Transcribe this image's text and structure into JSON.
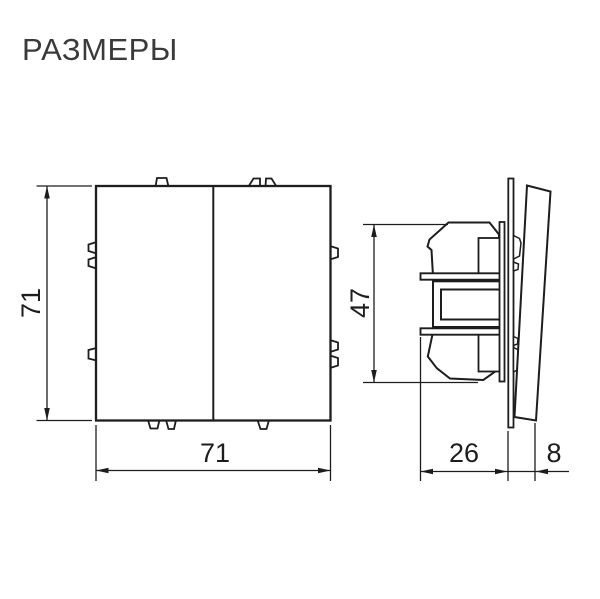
{
  "title": "РАЗМЕРЫ",
  "drawing": {
    "description": "Dimensional technical drawing of a two-rocker wall switch: front view and side view",
    "front_view": {
      "width": "71",
      "height": "71"
    },
    "side_view": {
      "mechanism_height": "47",
      "mechanism_depth": "26",
      "front_protrusion": "8"
    },
    "colors": {
      "line": "#1d1d1d",
      "title_text": "#3a3a3a",
      "background": "#ffffff"
    }
  }
}
